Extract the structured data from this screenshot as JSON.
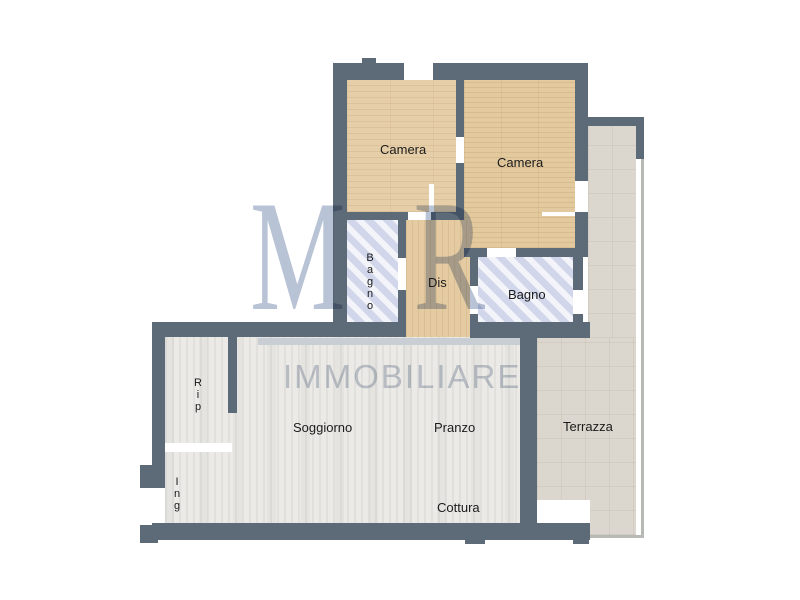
{
  "watermark": {
    "monogram": "MR",
    "brand": "IMMOBILIARE"
  },
  "plan": {
    "rooms": [
      {
        "id": "camera-1",
        "label": "Camera"
      },
      {
        "id": "camera-2",
        "label": "Camera"
      },
      {
        "id": "bagno-1",
        "label": "Bagno"
      },
      {
        "id": "dis",
        "label": "Dis"
      },
      {
        "id": "bagno-2",
        "label": "Bagno"
      },
      {
        "id": "rip",
        "label": "Rip"
      },
      {
        "id": "ing",
        "label": "Ing"
      },
      {
        "id": "soggiorno",
        "label": "Soggiorno"
      },
      {
        "id": "pranzo",
        "label": "Pranzo"
      },
      {
        "id": "cottura",
        "label": "Cottura"
      },
      {
        "id": "terrazza",
        "label": "Terrazza"
      }
    ],
    "colors": {
      "wall": "#5d6b79",
      "bedroom_floor": "#e6cfa8",
      "bath_floor": "#dcdfef",
      "living_floor": "#ebeae7",
      "terrace_floor": "#dcd7ce",
      "watermark": "#b9c3d6"
    }
  }
}
